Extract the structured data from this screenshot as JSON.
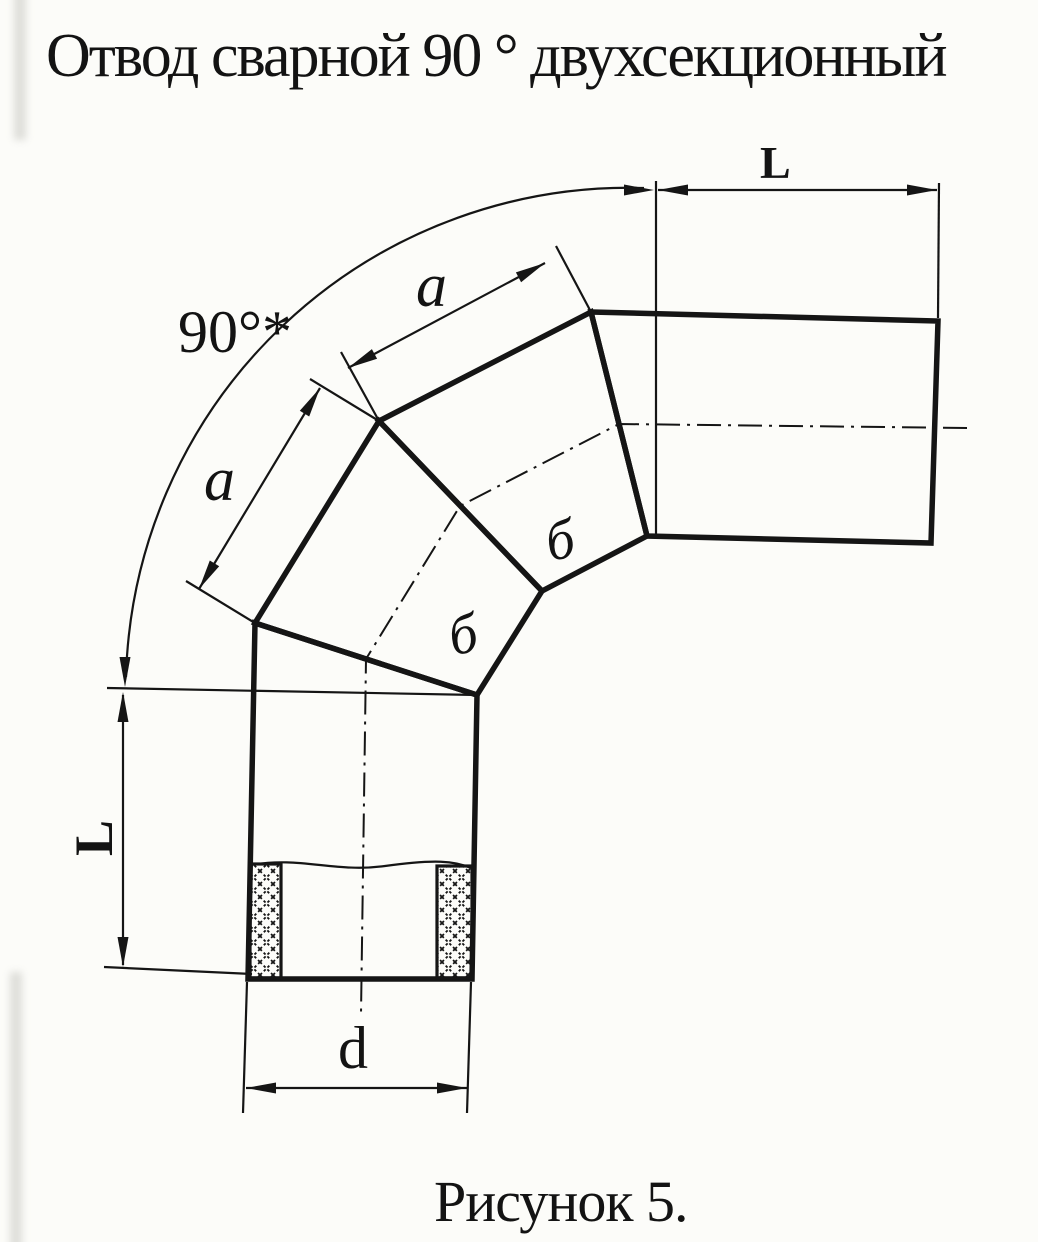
{
  "title": "Отвод сварной 90 ° двухсекционный",
  "caption": "Рисунок 5.",
  "diagram": {
    "type": "welded 90-degree two-section pipe elbow, dimensioned engineering drawing",
    "angle_label": "90°*",
    "top_length_label": "L",
    "left_length_label": "L",
    "upper_segment_label": "a",
    "lower_segment_label": "a",
    "diameter_label": "d",
    "weld_label_1": "б",
    "weld_label_2": "б"
  },
  "colors": {
    "ink": "#151515",
    "paper": "#fcfcf9"
  }
}
